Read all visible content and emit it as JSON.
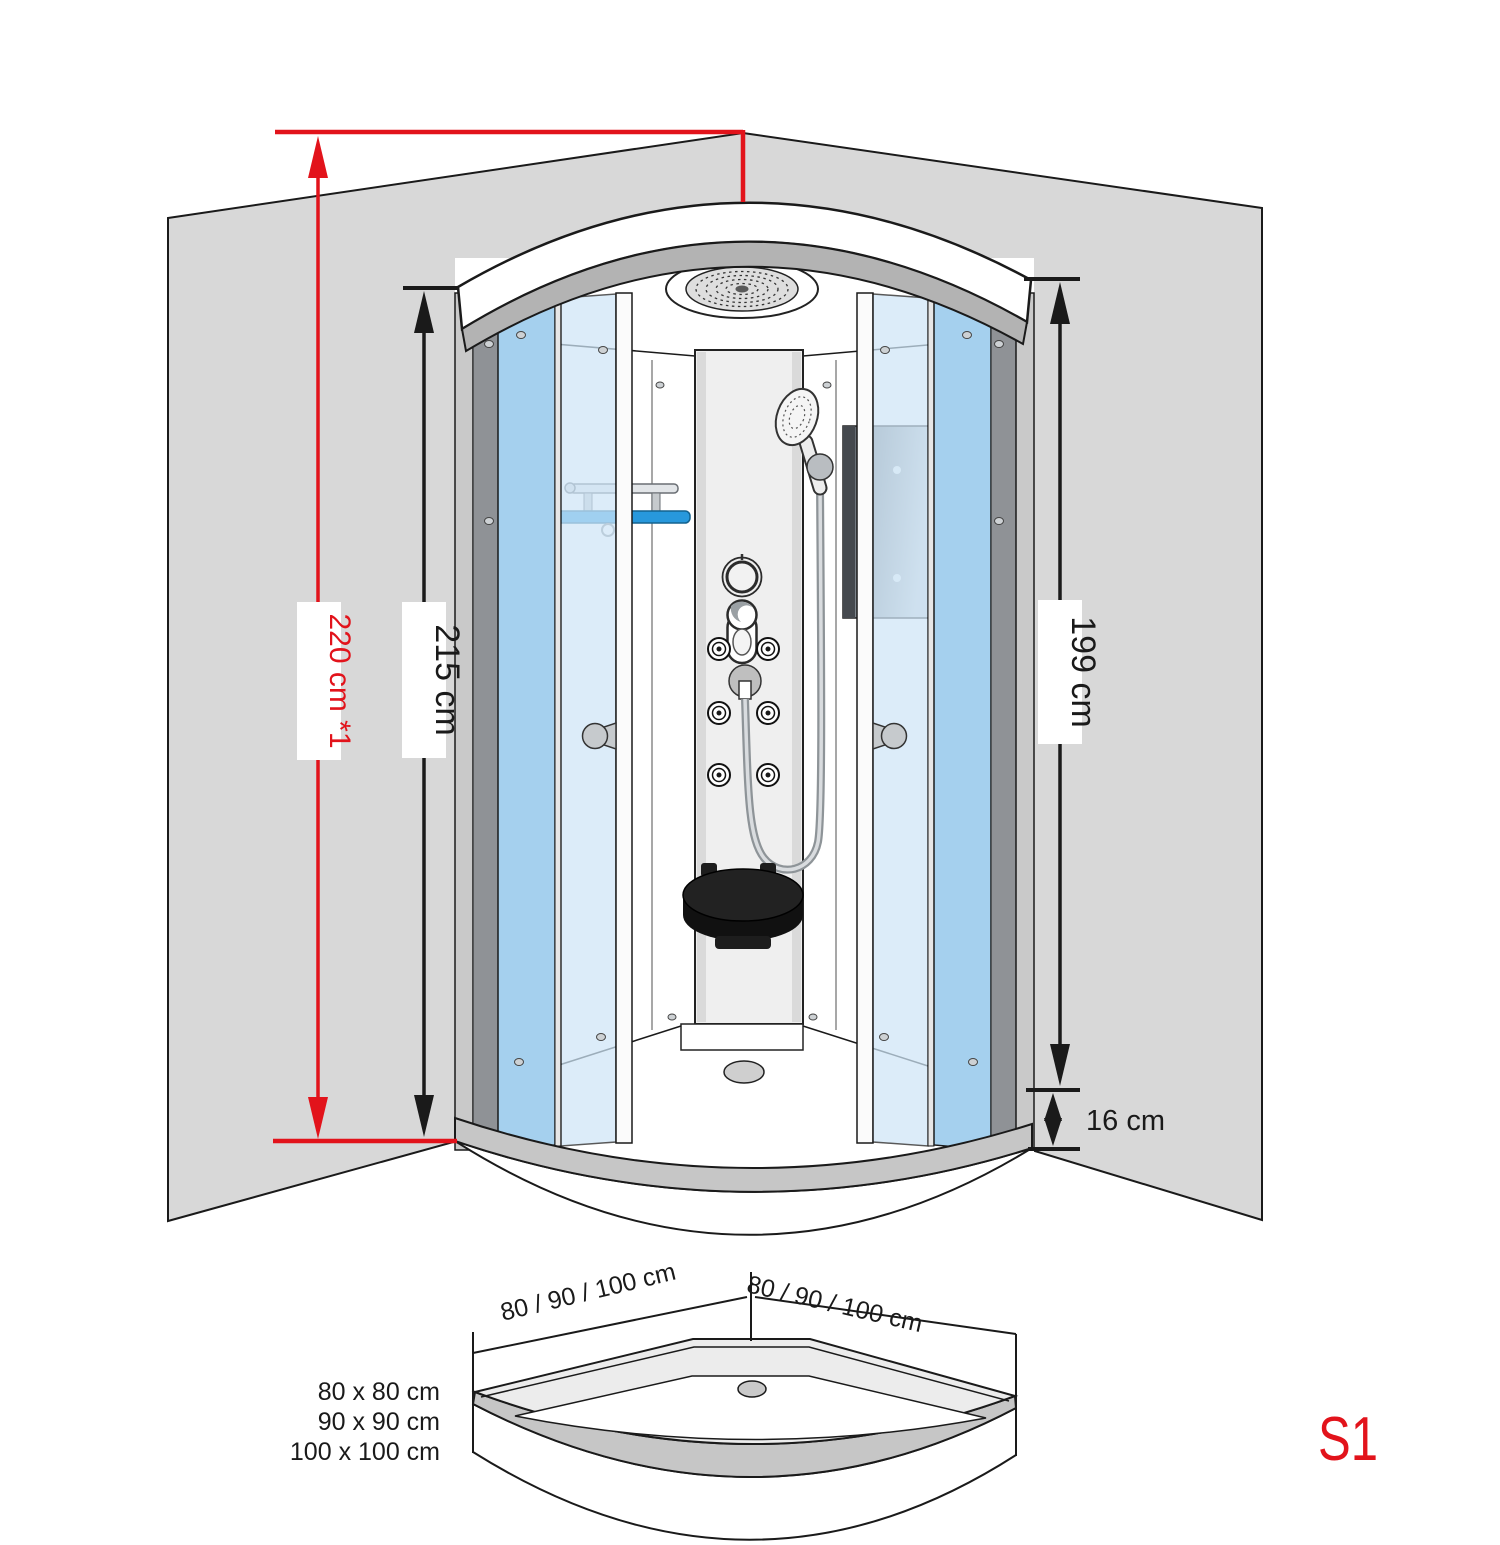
{
  "colors": {
    "dimension_red": "#e2131b",
    "line_black": "#1a1a1a",
    "wall_gray": "#d8d8d8",
    "canopy_gray": "#b3b3b3",
    "glass_medium_blue": "#a5d0ee",
    "glass_light_blue": "#cfe6f8",
    "shelf_blue": "#2798dc",
    "seat_black": "#1d1d1d"
  },
  "dimensions": {
    "ceiling_height": {
      "label": "220 cm *1"
    },
    "cabin_height": {
      "label": "215 cm"
    },
    "inner_height": {
      "label": "199 cm"
    },
    "tray_height": {
      "label": "16 cm"
    }
  },
  "tray_view": {
    "left_edge_label": "80 / 90 / 100 cm",
    "right_edge_label": "80 / 90 / 100 cm",
    "available_sizes": [
      "80 x 80 cm",
      "90 x 90 cm",
      "100 x 100 cm"
    ]
  },
  "model": {
    "code": "S1"
  }
}
